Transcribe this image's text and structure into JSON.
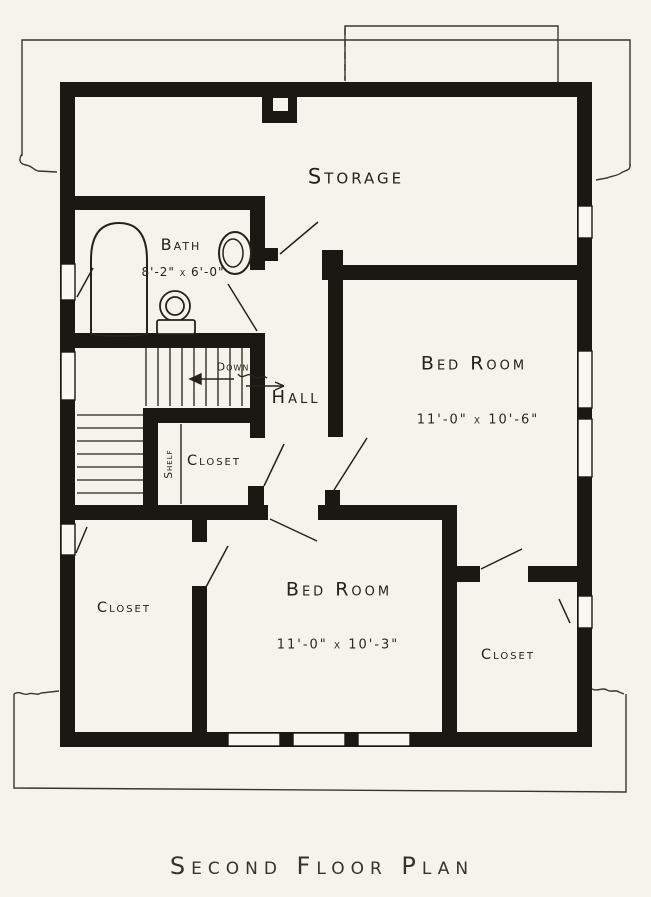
{
  "page": {
    "caption": "Second Floor Plan",
    "paper_color": "#f6f3ec",
    "ink_color": "#1b1813"
  },
  "rooms": {
    "storage": {
      "label": "Storage"
    },
    "bath": {
      "label": "Bath",
      "dims": "8'-2\" x 6'-0\""
    },
    "hall": {
      "label": "Hall"
    },
    "hall_closet": {
      "label": "Closet",
      "shelf_label": "Shelf"
    },
    "bedroom_right": {
      "label": "Bed Room",
      "dims": "11'-0\" x 10'-6\""
    },
    "bedroom_lower": {
      "label": "Bed Room",
      "dims": "11'-0\" x 10'-3\""
    },
    "closet_left": {
      "label": "Closet"
    },
    "closet_lower_right": {
      "label": "Closet"
    }
  },
  "stairs": {
    "down_label": "Down"
  }
}
